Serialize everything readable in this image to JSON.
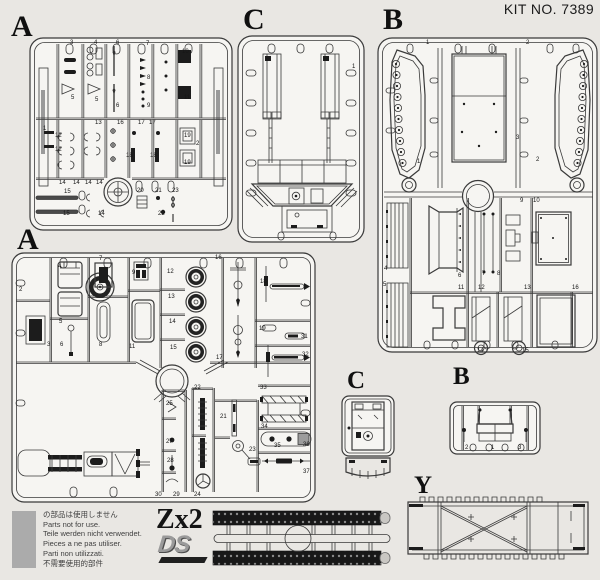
{
  "header": {
    "kit_no": "KIT NO. 7389"
  },
  "colors": {
    "page_bg": "#e9e7e3",
    "panel_fill": "#f6f5f2",
    "line": "#3a3a3a",
    "dark_part": "#1c1c1c",
    "gray_swatch": "#ababab",
    "ds_gray": "#9a9a9a",
    "track_black": "#181818"
  },
  "sprues": {
    "a1": {
      "label": "A",
      "part_numbers": [
        {
          "n": "3",
          "x": 70,
          "y": 44
        },
        {
          "n": "4",
          "x": 94,
          "y": 44
        },
        {
          "n": "6",
          "x": 116,
          "y": 44
        },
        {
          "n": "7",
          "x": 146,
          "y": 45
        },
        {
          "n": "10",
          "x": 182,
          "y": 53
        },
        {
          "n": "8",
          "x": 147,
          "y": 79
        },
        {
          "n": "5",
          "x": 71,
          "y": 99
        },
        {
          "n": "5",
          "x": 95,
          "y": 101
        },
        {
          "n": "6",
          "x": 116,
          "y": 107
        },
        {
          "n": "9",
          "x": 147,
          "y": 107
        },
        {
          "n": "11",
          "x": 184,
          "y": 99
        },
        {
          "n": "1",
          "x": 43,
          "y": 130
        },
        {
          "n": "13",
          "x": 95,
          "y": 124
        },
        {
          "n": "16",
          "x": 117,
          "y": 124
        },
        {
          "n": "17",
          "x": 138,
          "y": 124
        },
        {
          "n": "17",
          "x": 149,
          "y": 124
        },
        {
          "n": "12",
          "x": 55,
          "y": 137
        },
        {
          "n": "12",
          "x": 55,
          "y": 151
        },
        {
          "n": "18",
          "x": 126,
          "y": 157
        },
        {
          "n": "18",
          "x": 150,
          "y": 157
        },
        {
          "n": "19",
          "x": 184,
          "y": 137
        },
        {
          "n": "19",
          "x": 184,
          "y": 164
        },
        {
          "n": "2",
          "x": 196,
          "y": 145
        },
        {
          "n": "14",
          "x": 59,
          "y": 184
        },
        {
          "n": "14",
          "x": 73,
          "y": 184
        },
        {
          "n": "14",
          "x": 85,
          "y": 184
        },
        {
          "n": "14",
          "x": 96,
          "y": 184
        },
        {
          "n": "15",
          "x": 64,
          "y": 193
        },
        {
          "n": "20",
          "x": 137,
          "y": 192
        },
        {
          "n": "21",
          "x": 155,
          "y": 192
        },
        {
          "n": "23",
          "x": 172,
          "y": 192
        },
        {
          "n": "15",
          "x": 63,
          "y": 215
        },
        {
          "n": "14",
          "x": 98,
          "y": 215
        },
        {
          "n": "22",
          "x": 158,
          "y": 215
        }
      ]
    },
    "c1": {
      "label": "C",
      "part_numbers": [
        {
          "n": "1",
          "x": 352,
          "y": 68
        }
      ]
    },
    "b1": {
      "label": "B",
      "part_numbers": [
        {
          "n": "1",
          "x": 426,
          "y": 44
        },
        {
          "n": "2",
          "x": 526,
          "y": 44
        },
        {
          "n": "3",
          "x": 516,
          "y": 139
        },
        {
          "n": "1",
          "x": 417,
          "y": 163
        },
        {
          "n": "2",
          "x": 536,
          "y": 161
        },
        {
          "n": "9",
          "x": 520,
          "y": 202
        },
        {
          "n": "10",
          "x": 533,
          "y": 202
        },
        {
          "n": "4",
          "x": 384,
          "y": 270
        },
        {
          "n": "5",
          "x": 383,
          "y": 286
        },
        {
          "n": "6",
          "x": 458,
          "y": 277
        },
        {
          "n": "7",
          "x": 482,
          "y": 275
        },
        {
          "n": "8",
          "x": 497,
          "y": 275
        },
        {
          "n": "11",
          "x": 458,
          "y": 289
        },
        {
          "n": "12",
          "x": 478,
          "y": 289
        },
        {
          "n": "13",
          "x": 524,
          "y": 289
        },
        {
          "n": "16",
          "x": 572,
          "y": 289
        },
        {
          "n": "14",
          "x": 477,
          "y": 352
        },
        {
          "n": "15",
          "x": 522,
          "y": 352
        }
      ]
    },
    "a2": {
      "label": "A",
      "part_numbers": [
        {
          "n": "2",
          "x": 19,
          "y": 291
        },
        {
          "n": "4",
          "x": 58,
          "y": 268
        },
        {
          "n": "7",
          "x": 99,
          "y": 260
        },
        {
          "n": "9",
          "x": 132,
          "y": 274
        },
        {
          "n": "12",
          "x": 167,
          "y": 273
        },
        {
          "n": "13",
          "x": 168,
          "y": 298
        },
        {
          "n": "14",
          "x": 169,
          "y": 323
        },
        {
          "n": "15",
          "x": 170,
          "y": 349
        },
        {
          "n": "16",
          "x": 215,
          "y": 259
        },
        {
          "n": "17",
          "x": 216,
          "y": 359
        },
        {
          "n": "3",
          "x": 47,
          "y": 346
        },
        {
          "n": "5",
          "x": 59,
          "y": 323
        },
        {
          "n": "6",
          "x": 60,
          "y": 346
        },
        {
          "n": "8",
          "x": 99,
          "y": 346
        },
        {
          "n": "11",
          "x": 129,
          "y": 348
        },
        {
          "n": "18",
          "x": 260,
          "y": 283
        },
        {
          "n": "19",
          "x": 259,
          "y": 330
        },
        {
          "n": "31",
          "x": 301,
          "y": 338
        },
        {
          "n": "32",
          "x": 302,
          "y": 356
        },
        {
          "n": "22",
          "x": 194,
          "y": 389
        },
        {
          "n": "33",
          "x": 260,
          "y": 389
        },
        {
          "n": "21",
          "x": 220,
          "y": 418
        },
        {
          "n": "34",
          "x": 261,
          "y": 428
        },
        {
          "n": "25",
          "x": 166,
          "y": 405
        },
        {
          "n": "27",
          "x": 166,
          "y": 443
        },
        {
          "n": "28",
          "x": 167,
          "y": 462
        },
        {
          "n": "23",
          "x": 249,
          "y": 451
        },
        {
          "n": "35",
          "x": 274,
          "y": 447
        },
        {
          "n": "36",
          "x": 303,
          "y": 446
        },
        {
          "n": "37",
          "x": 303,
          "y": 473
        },
        {
          "n": "30",
          "x": 155,
          "y": 496
        },
        {
          "n": "29",
          "x": 173,
          "y": 496
        },
        {
          "n": "24",
          "x": 194,
          "y": 496
        }
      ]
    },
    "c2": {
      "label": "C",
      "part_numbers": []
    },
    "b2": {
      "label": "B",
      "part_numbers": [
        {
          "n": "2",
          "x": 465,
          "y": 449
        },
        {
          "n": "1",
          "x": 491,
          "y": 449
        },
        {
          "n": "3",
          "x": 518,
          "y": 449
        }
      ]
    },
    "y": {
      "label": "Y",
      "part_numbers": []
    }
  },
  "footer": {
    "not_used_lines": [
      "の部品は使用しません",
      "Parts not for use.",
      "Teile werden nicht verwendet.",
      "Pieces a ne pas utiliser.",
      "Parti non utilizzati.",
      "不需要使用的部件"
    ],
    "quantity_label": "Zx2",
    "brand_label": "DS"
  }
}
